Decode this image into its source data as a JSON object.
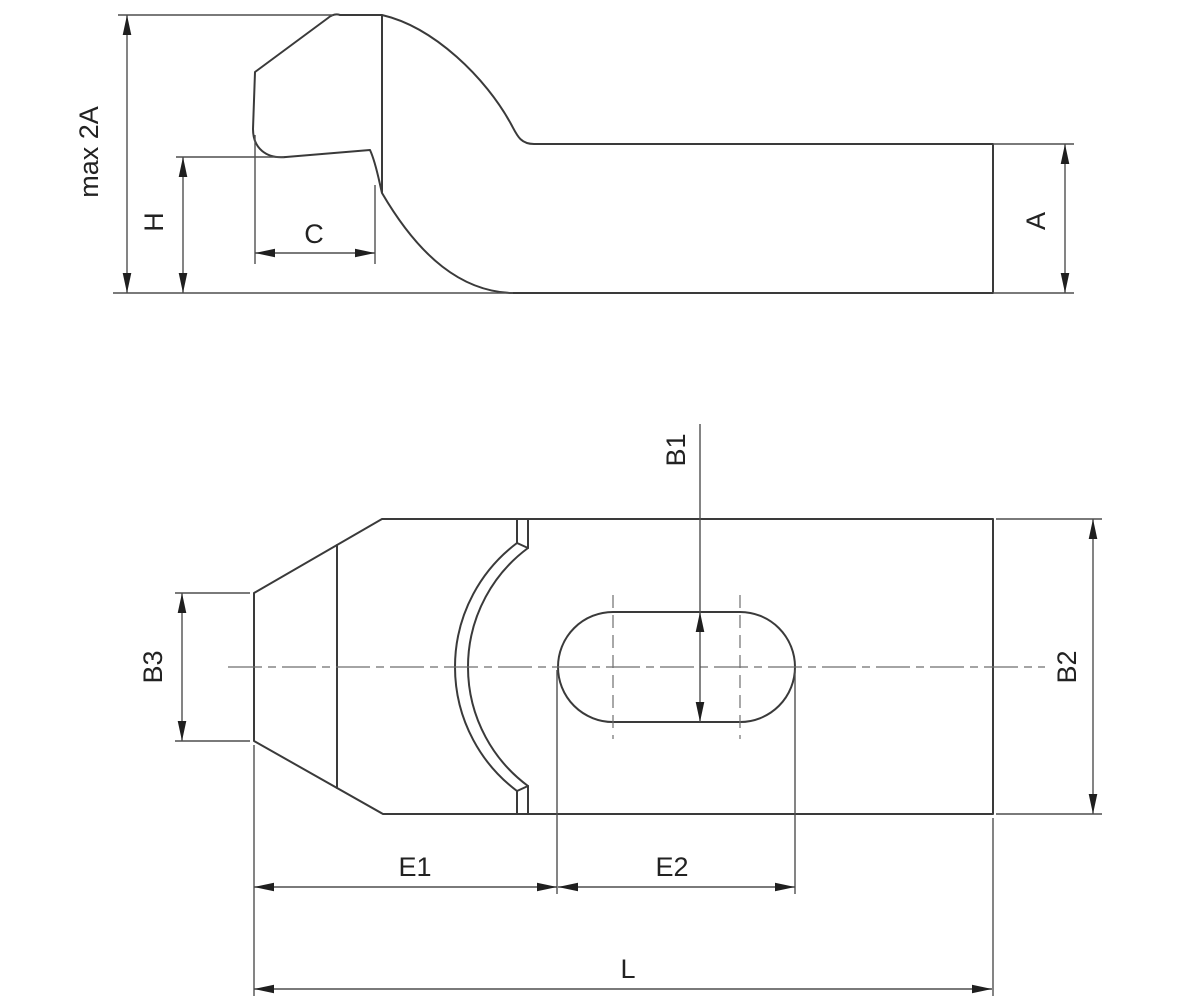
{
  "drawing": {
    "description": "Two-view technical drawing of a gooseneck clamp strap",
    "colors": {
      "background": "#ffffff",
      "outline": "#3a3a3a",
      "dimension": "#4f4f4f",
      "centerline": "#6e6e6e",
      "arrow": "#1f1f1f",
      "text": "#222222"
    },
    "views": {
      "side_view": {
        "labels": {
          "max_2a": "max 2A",
          "h": "H",
          "c": "C",
          "a": "A"
        }
      },
      "plan_view": {
        "labels": {
          "b1": "B1",
          "b2": "B2",
          "b3": "B3",
          "e1": "E1",
          "e2": "E2",
          "l": "L"
        }
      }
    }
  }
}
